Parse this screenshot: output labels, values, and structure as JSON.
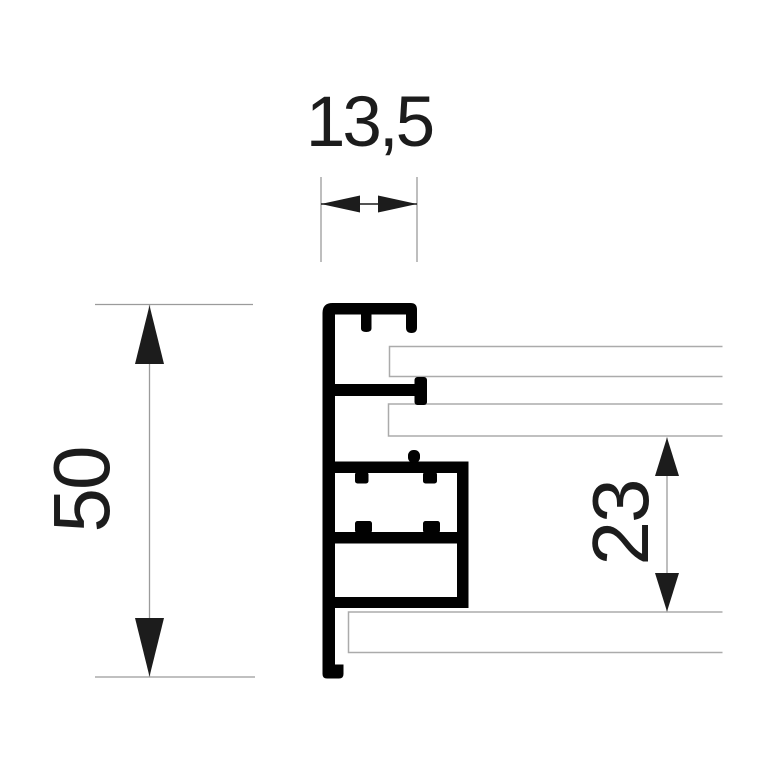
{
  "drawing": {
    "dimensions": {
      "top_width": "13,5",
      "left_height": "50",
      "right_height": "23"
    }
  },
  "colors": {
    "background": "#ffffff",
    "profile": "#010101",
    "panel_outline": "#ababab",
    "dim_line": "#9b9b9b",
    "arrow": "#1c1c1c",
    "label": "#1c1c1c"
  }
}
